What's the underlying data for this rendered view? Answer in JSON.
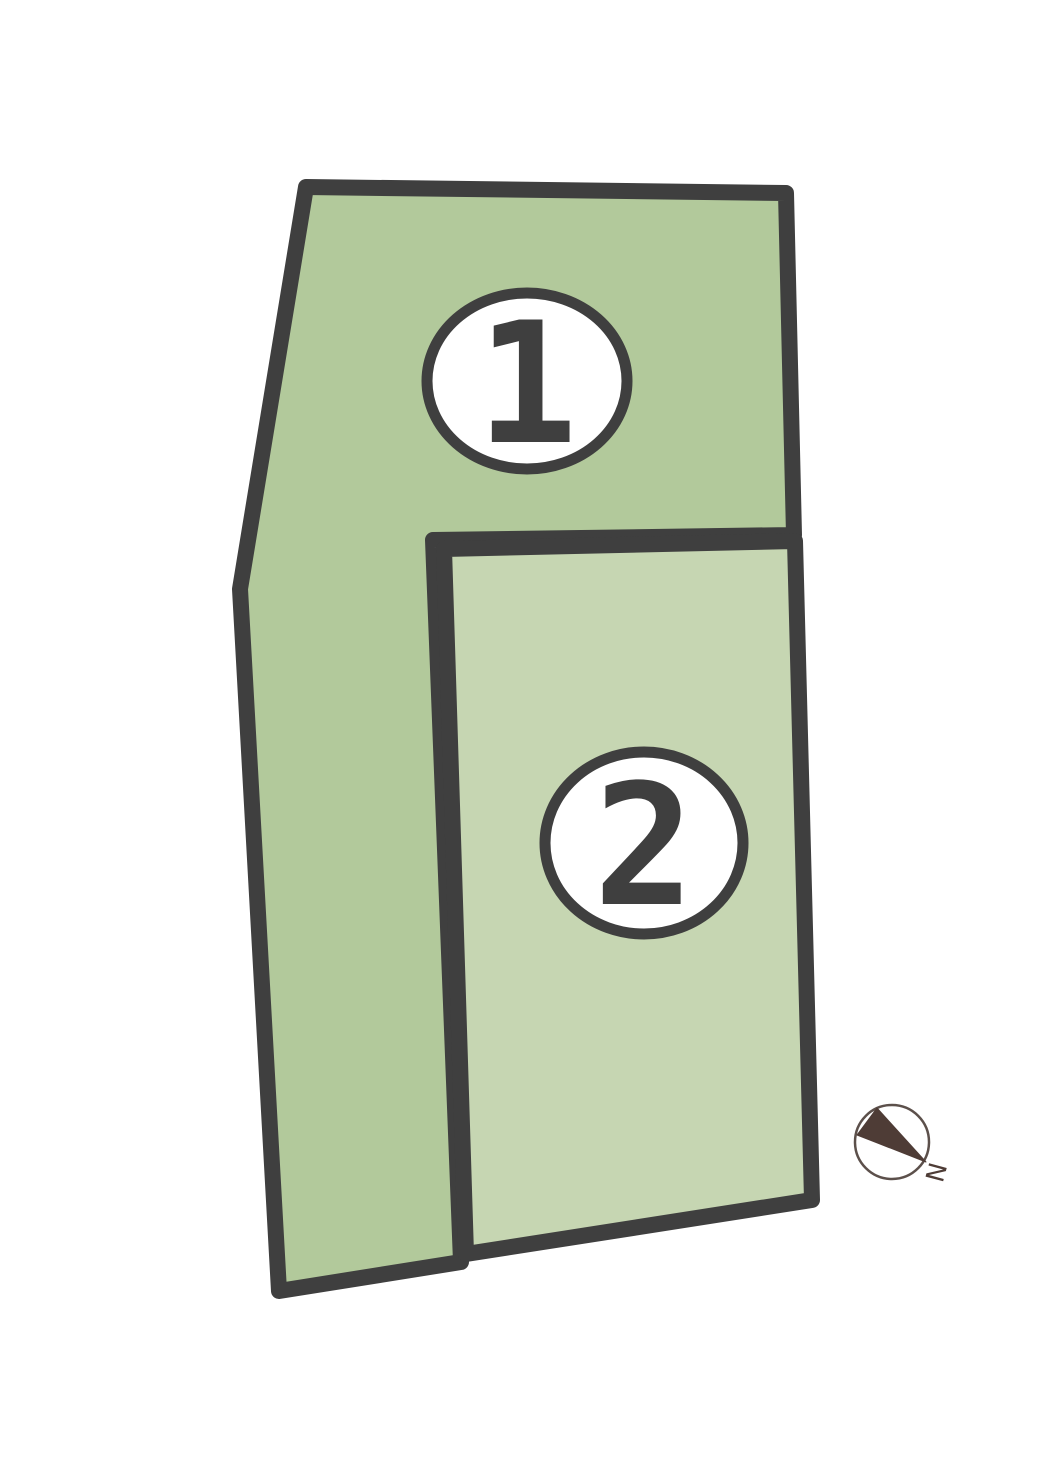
{
  "plan": {
    "parcels": [
      {
        "label": "1"
      },
      {
        "label": "2"
      }
    ],
    "compass": {
      "label": "N"
    }
  },
  "colors": {
    "parcel1_fill": "#b2c99b",
    "parcel2_fill": "#c6d6b2",
    "border": "#3f3f3f",
    "badge_fill": "#ffffff",
    "badge_border": "#3f3f3f",
    "badge_text": "#3f3f3f",
    "compass_needle": "#4e3c36",
    "compass_ring": "#5c504b",
    "compass_text": "#4e3c36",
    "background": "#ffffff"
  }
}
